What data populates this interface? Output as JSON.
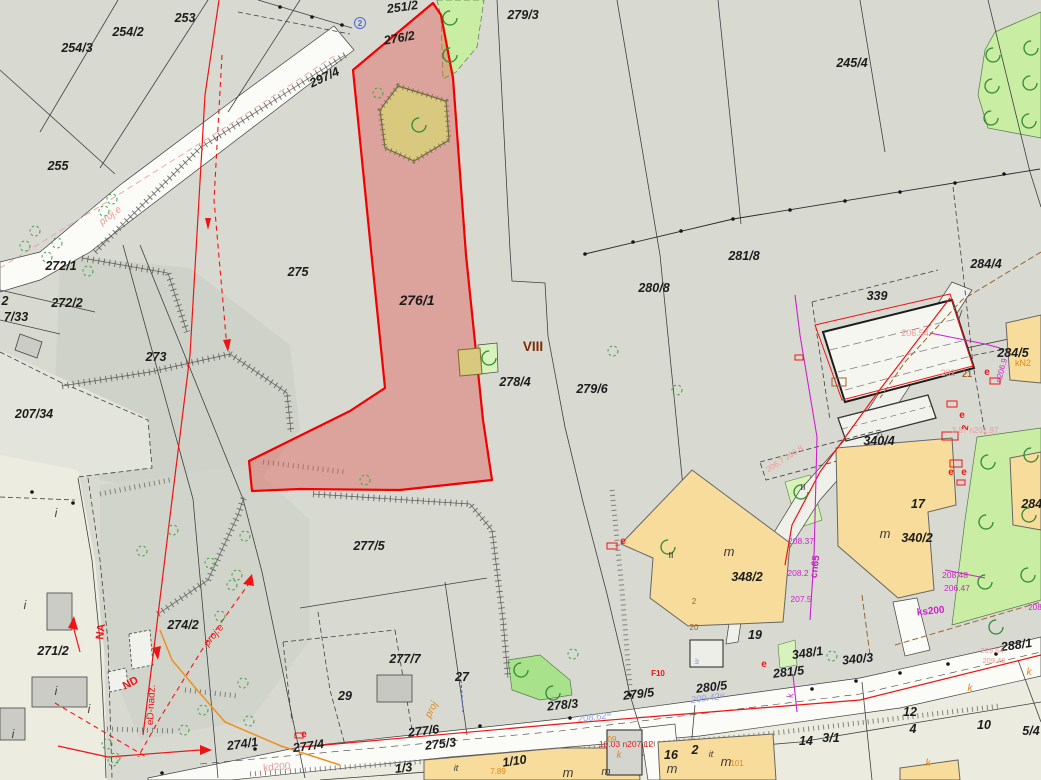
{
  "map": {
    "type": "cadastral-parcel-map",
    "highlighted_parcel": "276/1",
    "zone_label": "VIII",
    "labels": [
      {
        "t": "253",
        "x": 185,
        "y": 22
      },
      {
        "t": "254/2",
        "x": 128,
        "y": 36
      },
      {
        "t": "254/3",
        "x": 77,
        "y": 52
      },
      {
        "t": "255",
        "x": 58,
        "y": 170
      },
      {
        "t": "251/2",
        "x": 403,
        "y": 11,
        "r": -8
      },
      {
        "t": "276/2",
        "x": 400,
        "y": 42,
        "r": -10
      },
      {
        "t": "297/4",
        "x": 326,
        "y": 81,
        "r": -25
      },
      {
        "t": "279/3",
        "x": 523,
        "y": 19
      },
      {
        "t": "245/4",
        "x": 852,
        "y": 67
      },
      {
        "t": "272/1",
        "x": 61,
        "y": 270
      },
      {
        "t": "272/2",
        "x": 67,
        "y": 307
      },
      {
        "t": "2",
        "x": 5,
        "y": 305
      },
      {
        "t": "7/33",
        "x": 16,
        "y": 321
      },
      {
        "t": "207/34",
        "x": 34,
        "y": 418
      },
      {
        "t": "273",
        "x": 156,
        "y": 361
      },
      {
        "t": "275",
        "x": 298,
        "y": 276
      },
      {
        "t": "276/1",
        "x": 417,
        "y": 305,
        "s": 14
      },
      {
        "t": "278/4",
        "x": 515,
        "y": 386
      },
      {
        "t": "279/6",
        "x": 592,
        "y": 393
      },
      {
        "t": "280/8",
        "x": 654,
        "y": 292
      },
      {
        "t": "281/8",
        "x": 744,
        "y": 260
      },
      {
        "t": "284/4",
        "x": 986,
        "y": 268
      },
      {
        "t": "339",
        "x": 877,
        "y": 300
      },
      {
        "t": "284/5",
        "x": 1013,
        "y": 357
      },
      {
        "t": "340/4",
        "x": 879,
        "y": 445
      },
      {
        "t": "17",
        "x": 918,
        "y": 508
      },
      {
        "t": "340/2",
        "x": 917,
        "y": 542
      },
      {
        "t": "348/2",
        "x": 747,
        "y": 581
      },
      {
        "t": "19",
        "x": 755,
        "y": 639
      },
      {
        "t": "348/1",
        "x": 808,
        "y": 657,
        "r": -8
      },
      {
        "t": "340/3",
        "x": 858,
        "y": 663,
        "r": -6
      },
      {
        "t": "281/5",
        "x": 789,
        "y": 676,
        "r": -7
      },
      {
        "t": "280/5",
        "x": 712,
        "y": 691,
        "r": -7
      },
      {
        "t": "279/5",
        "x": 639,
        "y": 698,
        "r": -7
      },
      {
        "t": "288/1",
        "x": 1017,
        "y": 649,
        "r": -8
      },
      {
        "t": "278/3",
        "x": 563,
        "y": 709,
        "r": -6
      },
      {
        "t": "277/5",
        "x": 369,
        "y": 550
      },
      {
        "t": "277/7",
        "x": 405,
        "y": 663
      },
      {
        "t": "27",
        "x": 462,
        "y": 681
      },
      {
        "t": "29",
        "x": 345,
        "y": 700
      },
      {
        "t": "277/6",
        "x": 424,
        "y": 735,
        "r": -7
      },
      {
        "t": "275/3",
        "x": 441,
        "y": 748,
        "r": -7
      },
      {
        "t": "1/3",
        "x": 404,
        "y": 772,
        "r": -7
      },
      {
        "t": "274/1",
        "x": 243,
        "y": 748,
        "r": -8
      },
      {
        "t": "277/4",
        "x": 309,
        "y": 750,
        "r": -8
      },
      {
        "t": "271/2",
        "x": 53,
        "y": 655
      },
      {
        "t": "274/2",
        "x": 183,
        "y": 629
      },
      {
        "t": "12",
        "x": 910,
        "y": 716
      },
      {
        "t": "4",
        "x": 913,
        "y": 733
      },
      {
        "t": "14",
        "x": 806,
        "y": 745
      },
      {
        "t": "3/1",
        "x": 831,
        "y": 742
      },
      {
        "t": "10",
        "x": 984,
        "y": 729
      },
      {
        "t": "5/4",
        "x": 1031,
        "y": 735
      },
      {
        "t": "16",
        "x": 671,
        "y": 759
      },
      {
        "t": "2",
        "x": 695,
        "y": 754
      },
      {
        "t": "1/10",
        "x": 515,
        "y": 765,
        "r": -8
      },
      {
        "t": "284/1",
        "x": 1037,
        "y": 508
      },
      {
        "t": "VIII",
        "x": 533,
        "y": 351,
        "c": "darkred",
        "s": 13.5,
        "f": "b"
      },
      {
        "t": "m",
        "x": 729,
        "y": 556,
        "c": "ink2",
        "s": 13,
        "f": "iS"
      },
      {
        "t": "m",
        "x": 885,
        "y": 538,
        "c": "ink2",
        "s": 13,
        "f": "iS"
      },
      {
        "t": "m",
        "x": 568,
        "y": 777,
        "c": "ink2",
        "s": 13,
        "f": "iS"
      },
      {
        "t": "m",
        "x": 672,
        "y": 773,
        "c": "ink2",
        "s": 13,
        "f": "iS"
      },
      {
        "t": "m",
        "x": 726,
        "y": 766,
        "c": "ink2",
        "s": 13,
        "f": "iS"
      },
      {
        "t": "m",
        "x": 606,
        "y": 775,
        "c": "ink2",
        "s": 11,
        "f": "iS"
      },
      {
        "t": "i",
        "x": 56,
        "y": 517,
        "c": "ink2",
        "s": 12,
        "f": "iS"
      },
      {
        "t": "i",
        "x": 25,
        "y": 609,
        "c": "ink2",
        "s": 12,
        "f": "iS"
      },
      {
        "t": "i",
        "x": 56,
        "y": 695,
        "c": "ink2",
        "s": 12,
        "f": "iS"
      },
      {
        "t": "i",
        "x": 89,
        "y": 713,
        "c": "ink2",
        "s": 12,
        "f": "iS"
      },
      {
        "t": "i",
        "x": 13,
        "y": 738,
        "c": "ink2",
        "s": 12,
        "f": "iS"
      },
      {
        "t": "it",
        "x": 456,
        "y": 771,
        "c": "ink2",
        "s": 9,
        "f": "iS"
      },
      {
        "t": "it",
        "x": 711,
        "y": 757,
        "c": "ink2",
        "s": 9,
        "f": "iS"
      },
      {
        "t": "II",
        "x": 803,
        "y": 490,
        "s": 8.5,
        "f": "n"
      },
      {
        "t": "II",
        "x": 671,
        "y": 558,
        "s": 8.5,
        "f": "n"
      },
      {
        "t": "206.54",
        "x": 915,
        "y": 336,
        "c": "palered",
        "s": 9,
        "f": "n"
      },
      {
        "t": "202",
        "x": 948,
        "y": 376,
        "c": "palered",
        "s": 9,
        "f": "n"
      },
      {
        "t": "3.87 n201.97",
        "x": 975,
        "y": 433,
        "c": "palered",
        "s": 8,
        "f": "n"
      },
      {
        "t": "206.7 206.8",
        "x": 786,
        "y": 461,
        "c": "palered",
        "s": 8,
        "f": "n",
        "r": -33
      },
      {
        "t": "209.64",
        "x": 992,
        "y": 653,
        "c": "palered",
        "s": 7.5,
        "f": "n"
      },
      {
        "t": "209.46",
        "x": 994,
        "y": 663,
        "c": "palered",
        "s": 7.5,
        "f": "n"
      },
      {
        "t": "kd200",
        "x": 277,
        "y": 770,
        "c": "palered",
        "s": 10,
        "f": "n",
        "r": -4
      },
      {
        "t": "proj.e",
        "x": 112,
        "y": 218,
        "c": "palered",
        "s": 10,
        "f": "i",
        "r": -37
      },
      {
        "t": "21",
        "x": 967,
        "y": 377,
        "c": "brown",
        "s": 9,
        "f": "b"
      },
      {
        "t": "2",
        "x": 694,
        "y": 604,
        "c": "brown",
        "s": 8,
        "f": "n"
      },
      {
        "t": "20",
        "x": 694,
        "y": 630,
        "c": "brown",
        "s": 8,
        "f": "n"
      },
      {
        "t": "cn65",
        "x": 818,
        "y": 567,
        "c": "magenta",
        "s": 10,
        "f": "b",
        "r": -83
      },
      {
        "t": "208.37",
        "x": 801,
        "y": 544,
        "c": "magenta",
        "s": 8.5,
        "f": "n"
      },
      {
        "t": "208.2",
        "x": 798,
        "y": 576,
        "c": "magenta",
        "s": 8.5,
        "f": "n"
      },
      {
        "t": "207.5",
        "x": 801,
        "y": 602,
        "c": "magenta",
        "s": 8.5,
        "f": "n"
      },
      {
        "t": "208.48",
        "x": 955,
        "y": 578,
        "c": "magenta",
        "s": 8.5,
        "f": "n"
      },
      {
        "t": "206.47",
        "x": 957,
        "y": 591,
        "c": "magenta",
        "s": 8.5,
        "f": "n"
      },
      {
        "t": "ks200",
        "x": 931,
        "y": 614,
        "c": "magenta",
        "s": 10,
        "f": "b",
        "r": -6
      },
      {
        "t": "208",
        "x": 1035,
        "y": 610,
        "c": "magenta",
        "s": 8,
        "f": "n"
      },
      {
        "t": "n206.9",
        "x": 1004,
        "y": 371,
        "c": "magenta",
        "s": 8,
        "f": "n",
        "r": -75
      },
      {
        "t": "k",
        "x": 793,
        "y": 696,
        "c": "magenta",
        "s": 9,
        "f": "n",
        "r": -80
      },
      {
        "t": "NA",
        "x": 104,
        "y": 632,
        "c": "red",
        "s": 11,
        "f": "b",
        "r": -83
      },
      {
        "t": "ND",
        "x": 132,
        "y": 686,
        "c": "red",
        "s": 11,
        "f": "b",
        "r": -28
      },
      {
        "t": "eD-nadz.",
        "x": 154,
        "y": 705,
        "c": "red",
        "s": 10,
        "f": "n",
        "r": -87
      },
      {
        "t": "proj.e",
        "x": 216,
        "y": 637,
        "c": "red",
        "s": 10,
        "f": "i",
        "r": -50
      },
      {
        "t": "F10",
        "x": 658,
        "y": 676,
        "c": "red",
        "s": 8,
        "f": "b"
      },
      {
        "t": "e",
        "x": 623,
        "y": 544,
        "c": "red",
        "s": 10,
        "f": "b"
      },
      {
        "t": "e",
        "x": 764,
        "y": 667,
        "c": "red",
        "s": 10,
        "f": "b"
      },
      {
        "t": "e",
        "x": 962,
        "y": 418,
        "c": "red",
        "s": 10,
        "f": "b"
      },
      {
        "t": "e",
        "x": 951,
        "y": 475,
        "c": "red",
        "s": 10,
        "f": "b"
      },
      {
        "t": "e",
        "x": 964,
        "y": 475,
        "c": "red",
        "s": 10,
        "f": "b"
      },
      {
        "t": "e",
        "x": 987,
        "y": 375,
        "c": "red",
        "s": 10,
        "f": "b"
      },
      {
        "t": "e",
        "x": 304,
        "y": 737,
        "c": "red",
        "s": 10,
        "f": "b"
      },
      {
        "t": "10.03 n207.12",
        "x": 626,
        "y": 747,
        "c": "red",
        "s": 8.5,
        "f": "n"
      },
      {
        "t": "2",
        "x": 968,
        "y": 428,
        "c": "red",
        "s": 9,
        "f": "b",
        "r": -80
      },
      {
        "t": "k",
        "x": 619,
        "y": 758,
        "c": "orange",
        "s": 10,
        "f": "i"
      },
      {
        "t": "k",
        "x": 970,
        "y": 691,
        "c": "orange",
        "s": 10,
        "f": "i"
      },
      {
        "t": "k",
        "x": 1029,
        "y": 675,
        "c": "orange",
        "s": 10,
        "f": "i"
      },
      {
        "t": "k",
        "x": 928,
        "y": 766,
        "c": "orange",
        "s": 10,
        "f": "i"
      },
      {
        "t": "proj",
        "x": 434,
        "y": 711,
        "c": "orange",
        "s": 10,
        "f": "i",
        "r": -63
      },
      {
        "t": "09",
        "x": 612,
        "y": 742,
        "c": "orange",
        "s": 8,
        "f": "n"
      },
      {
        "t": "kN2",
        "x": 1023,
        "y": 366,
        "c": "orange",
        "s": 9,
        "f": "n"
      },
      {
        "t": "101",
        "x": 737,
        "y": 766,
        "c": "orange",
        "s": 8,
        "f": "n"
      },
      {
        "t": "7.89",
        "x": 498,
        "y": 774,
        "c": "orange",
        "s": 8,
        "f": "n"
      },
      {
        "t": "209.42ʷ",
        "x": 708,
        "y": 701,
        "c": "periwinkle",
        "s": 9.5,
        "f": "i",
        "r": -7
      },
      {
        "t": "208.62ʷ",
        "x": 595,
        "y": 720,
        "c": "periwinkle",
        "s": 9.5,
        "f": "i",
        "r": -7
      },
      {
        "t": "w",
        "x": 699,
        "y": 662,
        "c": "periwinkle",
        "s": 8,
        "f": "i",
        "r": -80
      },
      {
        "t": "2",
        "x": 360,
        "y": 26,
        "c": "blue",
        "s": 8,
        "f": "b"
      }
    ],
    "trees_open": [
      [
        450,
        18
      ],
      [
        450,
        55
      ],
      [
        419,
        125
      ],
      [
        489,
        358
      ],
      [
        993,
        55
      ],
      [
        1031,
        48
      ],
      [
        992,
        86
      ],
      [
        1030,
        83
      ],
      [
        1029,
        121
      ],
      [
        991,
        118
      ],
      [
        988,
        462
      ],
      [
        1031,
        455
      ],
      [
        986,
        522
      ],
      [
        1029,
        515
      ],
      [
        985,
        582
      ],
      [
        1028,
        575
      ],
      [
        996,
        627
      ],
      [
        521,
        670
      ],
      [
        553,
        693
      ],
      [
        668,
        547
      ],
      [
        801,
        492
      ]
    ],
    "trees_dashed": [
      [
        35,
        231
      ],
      [
        25,
        246
      ],
      [
        57,
        243
      ],
      [
        47,
        257
      ],
      [
        104,
        211
      ],
      [
        112,
        199
      ],
      [
        88,
        271
      ],
      [
        378,
        93
      ],
      [
        365,
        480
      ],
      [
        613,
        351
      ],
      [
        677,
        390
      ],
      [
        142,
        551
      ],
      [
        173,
        530
      ],
      [
        245,
        536
      ],
      [
        237,
        575
      ],
      [
        232,
        585
      ],
      [
        220,
        616
      ],
      [
        203,
        710
      ],
      [
        184,
        730
      ],
      [
        113,
        761
      ],
      [
        243,
        683
      ],
      [
        249,
        721
      ],
      [
        115,
        758
      ],
      [
        107,
        744
      ],
      [
        573,
        654
      ],
      [
        832,
        656
      ],
      [
        210,
        563
      ]
    ],
    "survey_dots": [
      [
        585,
        254
      ],
      [
        633,
        242
      ],
      [
        681,
        231
      ],
      [
        733,
        219
      ],
      [
        790,
        210
      ],
      [
        845,
        201
      ],
      [
        900,
        192
      ],
      [
        955,
        183
      ],
      [
        1004,
        174
      ],
      [
        812,
        689
      ],
      [
        856,
        681
      ],
      [
        900,
        673
      ],
      [
        948,
        664
      ],
      [
        996,
        654
      ],
      [
        162,
        773
      ],
      [
        255,
        749
      ],
      [
        480,
        726
      ],
      [
        570,
        718
      ],
      [
        32,
        492
      ],
      [
        73,
        503
      ],
      [
        280,
        7
      ],
      [
        312,
        17
      ],
      [
        342,
        25
      ],
      [
        630,
        695
      ]
    ]
  },
  "palette": {
    "ink": "#1c1c1c",
    "ink2": "#3c3c3c",
    "darkred": "#7c2a00",
    "red": "#ee1414",
    "palered": "#e89c96",
    "magenta": "#cb22cb",
    "orange": "#e08818",
    "brown": "#996532",
    "blue": "#4f66d6",
    "periwinkle": "#94a5e6",
    "bg": "#d8dad2",
    "cream": "#ecede0",
    "scrub": "#cfd2c8",
    "road": "#fbfbf7",
    "green": "#c9eda3",
    "greenstrip": "#d8f2bb",
    "khaki": "#d8c97f",
    "yellow": "#f7dc9b",
    "bldggrey": "#cbccc6",
    "white": "#f4f4ee",
    "highlight_fill": "rgba(224,95,88,0.45)",
    "highlight_stroke": "#f20000",
    "treegreen": "#2f8b2f"
  }
}
